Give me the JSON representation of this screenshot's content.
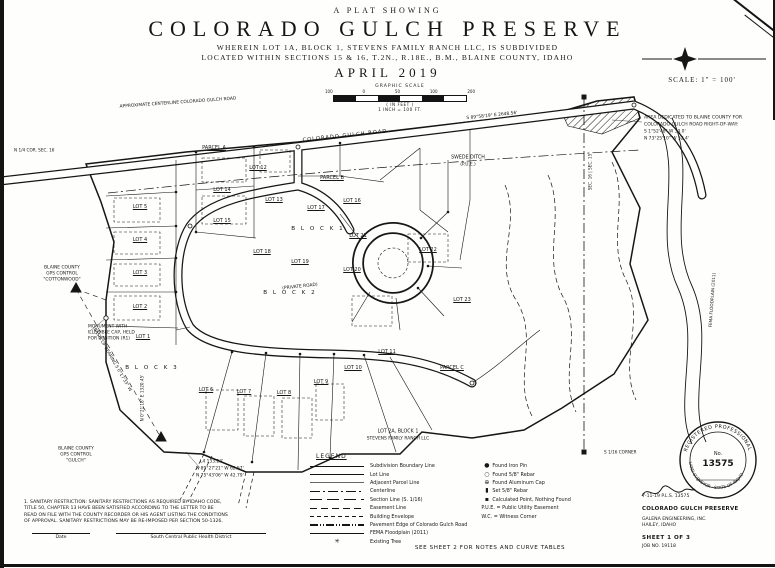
{
  "header": {
    "eyebrow": "A PLAT SHOWING",
    "title": "COLORADO GULCH PRESERVE",
    "sub1": "WHEREIN LOT 1A, BLOCK 1, STEVENS FAMILY RANCH LLC, IS SUBDIVIDED",
    "sub2": "LOCATED WITHIN SECTIONS 15 & 16, T.2N., R.18E., B.M., BLAINE COUNTY, IDAHO",
    "date": "APRIL 2019"
  },
  "scale": {
    "graphic_label": "GRAPHIC SCALE",
    "ticks": [
      "100",
      "0",
      "50",
      "100",
      "200"
    ],
    "feet_note": "( IN FEET )",
    "ratio_note": "1 INCH = 100 FT.",
    "scale_text": "SCALE: 1\" = 100'"
  },
  "map": {
    "labels": [
      {
        "t": "APPROXIMATE CENTERLINE COLORADO GULCH ROAD",
        "x": 178,
        "y": 103,
        "s": 4.4,
        "r": -4
      },
      {
        "t": "COLORADO GULCH ROAD",
        "x": 345,
        "y": 136,
        "s": 5.2,
        "r": -6,
        "sp": 1
      },
      {
        "t": "S 89°58'19\" E   2648.56'",
        "x": 492,
        "y": 116,
        "s": 4.4,
        "r": -6
      },
      {
        "t": "AREA DEDICATED TO BLAINE COUNTY FOR",
        "x": 644,
        "y": 118,
        "s": 4.6,
        "a": "left"
      },
      {
        "t": "COLORADO GULCH ROAD RIGHT-OF-WAY:",
        "x": 644,
        "y": 125,
        "s": 4.6,
        "a": "left"
      },
      {
        "t": "S 1°52'48\" W   33.0'",
        "x": 644,
        "y": 132,
        "s": 4.4,
        "a": "left"
      },
      {
        "t": "N 73°25'10\" W   52.4'",
        "x": 644,
        "y": 139,
        "s": 4.4,
        "a": "left"
      },
      {
        "t": "SWEDE DITCH",
        "x": 468,
        "y": 158,
        "s": 4.8
      },
      {
        "t": "(P.U.E.)",
        "x": 468,
        "y": 165,
        "s": 4.4
      },
      {
        "t": "PARCEL A",
        "x": 214,
        "y": 148,
        "s": 5,
        "u": 1
      },
      {
        "t": "PARCEL B",
        "x": 332,
        "y": 178,
        "s": 5,
        "u": 1
      },
      {
        "t": "PARCEL C",
        "x": 452,
        "y": 368,
        "s": 5,
        "u": 1
      },
      {
        "t": "B L O C K   1",
        "x": 318,
        "y": 229,
        "s": 5.6,
        "sp": 2
      },
      {
        "t": "B L O C K   2",
        "x": 290,
        "y": 293,
        "s": 5.6,
        "sp": 2
      },
      {
        "t": "B L O C K   3",
        "x": 152,
        "y": 368,
        "s": 5.6,
        "sp": 2
      },
      {
        "t": "LOT 5",
        "x": 140,
        "y": 207,
        "s": 5,
        "u": 1
      },
      {
        "t": "LOT 4",
        "x": 140,
        "y": 240,
        "s": 5,
        "u": 1
      },
      {
        "t": "LOT 3",
        "x": 140,
        "y": 273,
        "s": 5,
        "u": 1
      },
      {
        "t": "LOT 2",
        "x": 140,
        "y": 307,
        "s": 5,
        "u": 1
      },
      {
        "t": "LOT 1",
        "x": 143,
        "y": 337,
        "s": 5,
        "u": 1
      },
      {
        "t": "LOT 6",
        "x": 206,
        "y": 390,
        "s": 5,
        "u": 1
      },
      {
        "t": "LOT 7",
        "x": 244,
        "y": 392,
        "s": 5,
        "u": 1
      },
      {
        "t": "LOT 8",
        "x": 284,
        "y": 393,
        "s": 5,
        "u": 1
      },
      {
        "t": "LOT 9",
        "x": 321,
        "y": 382,
        "s": 5,
        "u": 1
      },
      {
        "t": "LOT 10",
        "x": 353,
        "y": 368,
        "s": 5,
        "u": 1
      },
      {
        "t": "LOT 11",
        "x": 387,
        "y": 352,
        "s": 5,
        "u": 1
      },
      {
        "t": "LOT 12",
        "x": 258,
        "y": 168,
        "s": 5,
        "u": 1
      },
      {
        "t": "LOT 13",
        "x": 274,
        "y": 200,
        "s": 5,
        "u": 1
      },
      {
        "t": "LOT 14",
        "x": 222,
        "y": 190,
        "s": 5,
        "u": 1
      },
      {
        "t": "LOT 15",
        "x": 222,
        "y": 221,
        "s": 5,
        "u": 1
      },
      {
        "t": "LOT 16",
        "x": 352,
        "y": 201,
        "s": 5,
        "u": 1
      },
      {
        "t": "LOT 17",
        "x": 316,
        "y": 208,
        "s": 5,
        "u": 1
      },
      {
        "t": "LOT 18",
        "x": 262,
        "y": 252,
        "s": 5,
        "u": 1
      },
      {
        "t": "LOT 19",
        "x": 300,
        "y": 262,
        "s": 5,
        "u": 1
      },
      {
        "t": "LOT 20",
        "x": 352,
        "y": 270,
        "s": 5,
        "u": 1
      },
      {
        "t": "LOT 21",
        "x": 358,
        "y": 236,
        "s": 5,
        "u": 1
      },
      {
        "t": "LOT 22",
        "x": 428,
        "y": 250,
        "s": 5,
        "u": 1
      },
      {
        "t": "LOT 23",
        "x": 462,
        "y": 300,
        "s": 5,
        "u": 1
      },
      {
        "t": "LOT 2A, BLOCK 1",
        "x": 398,
        "y": 432,
        "s": 4.8
      },
      {
        "t": "STEVENS FAMILY RANCH LLC",
        "x": 398,
        "y": 439,
        "s": 4.4
      },
      {
        "t": "BLAINE COUNTY",
        "x": 62,
        "y": 268,
        "s": 4.4
      },
      {
        "t": "GPS CONTROL",
        "x": 62,
        "y": 274,
        "s": 4.4
      },
      {
        "t": "\"COTTONWOOD\"",
        "x": 62,
        "y": 280,
        "s": 4.4
      },
      {
        "t": "MONUMENT WITH",
        "x": 88,
        "y": 327,
        "s": 4.4,
        "a": "left"
      },
      {
        "t": "ILLEGIBLE CAP, HELD",
        "x": 88,
        "y": 333,
        "s": 4.4,
        "a": "left"
      },
      {
        "t": "FOR POSITION (R1)",
        "x": 88,
        "y": 339,
        "s": 4.4,
        "a": "left"
      },
      {
        "t": "BASIS OF BEARING   S 0°17'33\" W",
        "x": 112,
        "y": 360,
        "s": 4.4,
        "r": 60
      },
      {
        "t": "BLAINE COUNTY",
        "x": 76,
        "y": 449,
        "s": 4.4
      },
      {
        "t": "GPS CONTROL",
        "x": 76,
        "y": 455,
        "s": 4.4
      },
      {
        "t": "\"GULCH\"",
        "x": 76,
        "y": 461,
        "s": 4.4
      },
      {
        "t": "N 1/4 COR. SEC. 16",
        "x": 14,
        "y": 150,
        "s": 4.2,
        "a": "left"
      },
      {
        "t": "N 0°21'18\" E   1320.45'",
        "x": 142,
        "y": 398,
        "s": 4.2,
        "r": -90
      },
      {
        "t": "L4   133.23'",
        "x": 200,
        "y": 462,
        "s": 4.4,
        "a": "left"
      },
      {
        "t": "N 89°27'21\" W   62.57'",
        "x": 196,
        "y": 469,
        "s": 4.4,
        "a": "left"
      },
      {
        "t": "N 75°43'06\" W   42.79'",
        "x": 196,
        "y": 476,
        "s": 4.4,
        "a": "left"
      },
      {
        "t": "SEC. 16 | SEC. 15",
        "x": 590,
        "y": 172,
        "s": 4.2,
        "r": -90
      },
      {
        "t": "FEMA FLOODPLAIN (2011)",
        "x": 712,
        "y": 300,
        "s": 4.2,
        "r": -86
      },
      {
        "t": "S 1/16 CORNER",
        "x": 604,
        "y": 452,
        "s": 4.2,
        "a": "left"
      },
      {
        "t": "(PRIVATE ROAD)",
        "x": 300,
        "y": 287,
        "s": 4.4,
        "r": -6
      }
    ]
  },
  "legend": {
    "title": "LEGEND",
    "tree_glyph": "✳",
    "line_items": [
      {
        "label": "Subdivision Boundary Line"
      },
      {
        "label": "Lot Line"
      },
      {
        "label": "Adjacent Parcel Line"
      },
      {
        "label": "Centerline"
      },
      {
        "label": "Section Line (S. 1/16)"
      },
      {
        "label": "Easement Line"
      },
      {
        "label": "Building Envelope"
      },
      {
        "label": "Pavement Edge of Colorado Gulch Road"
      },
      {
        "label": "FEMA Floodplain (2011)"
      },
      {
        "label": "Existing Tree"
      }
    ],
    "symbol_items": [
      {
        "glyph": "●",
        "label": "Found Iron Pin"
      },
      {
        "glyph": "○",
        "label": "Found 5/8\" Rebar"
      },
      {
        "glyph": "⊕",
        "label": "Found Aluminum Cap"
      },
      {
        "glyph": "▮",
        "label": "Set 5/8\" Rebar"
      },
      {
        "glyph": "▪",
        "label": "Calculated Point, Nothing Found"
      }
    ],
    "abbrev_items": [
      {
        "label": "P.U.E. = Public Utility Easement"
      },
      {
        "label": "W.C. = Witness Corner"
      }
    ]
  },
  "notes": {
    "lines": [
      "1. SANITARY RESTRICTION: SANITARY RESTRICTIONS AS REQUIRED BY IDAHO CODE,",
      "TITLE 50, CHAPTER 13 HAVE BEEN SATISFIED ACCORDING TO THE LETTER TO BE",
      "READ ON FILE WITH THE COUNTY RECORDER OR HIS AGENT LISTING THE CONDITIONS",
      "OF APPROVAL. SANITARY RESTRICTIONS MAY BE RE-IMPOSED PER SECTION 50-1326."
    ],
    "date_label": "Date",
    "agency_label": "South Central Public Health District"
  },
  "titleblock": {
    "surveyor_line": "7-11-19      P.L.S. 13575",
    "project": "COLORADO GULCH PRESERVE",
    "firm": "GALENA ENGINEERING, INC.",
    "firm_city": "HAILEY, IDAHO",
    "sheet": "SHEET 1 OF 3",
    "job": "JOB NO. 19118",
    "seal": {
      "top": "REGISTERED PROFESSIONAL",
      "bottom": "LAND SURVEYOR · STATE OF IDAHO",
      "no_label": "No.",
      "number": "13575"
    }
  },
  "footer": "SEE SHEET 2 FOR NOTES AND CURVE TABLES",
  "colors": {
    "ink": "#161616",
    "paper": "#fefefc"
  }
}
